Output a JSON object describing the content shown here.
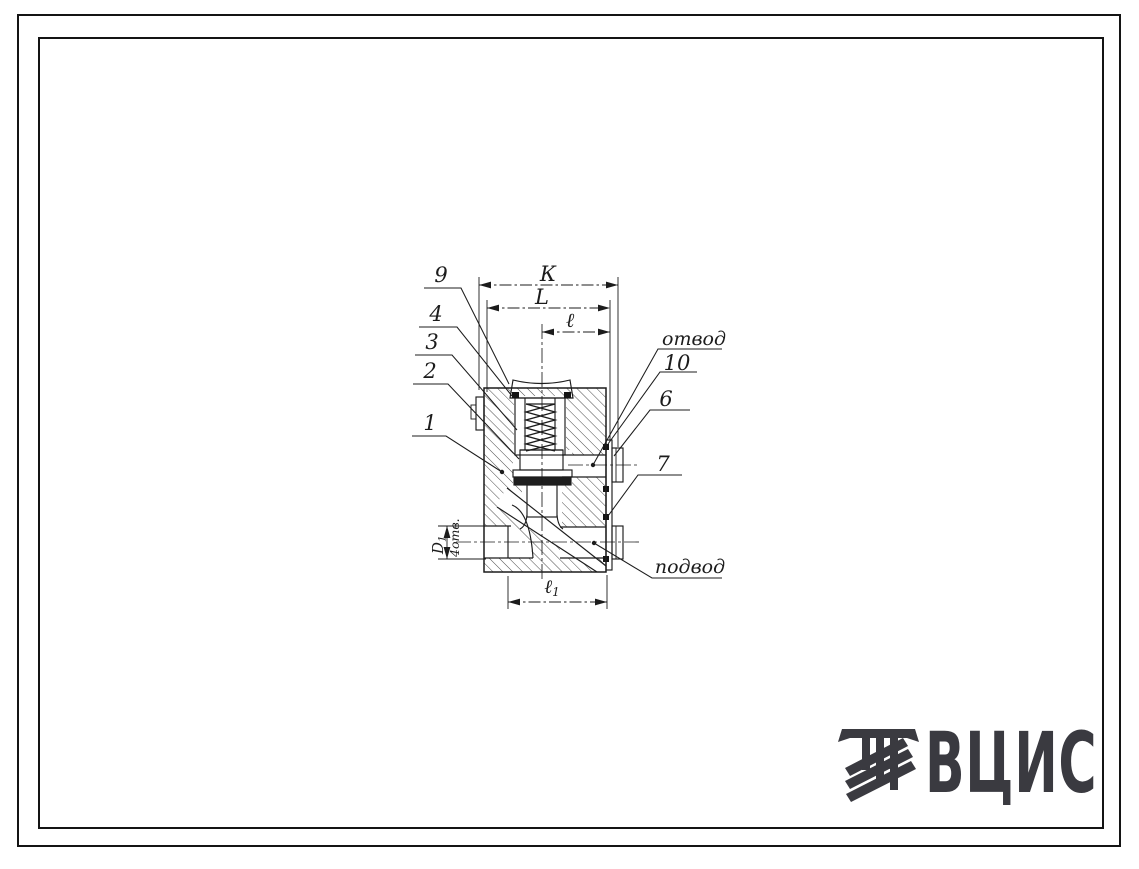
{
  "drawing": {
    "callouts": {
      "n9": "9",
      "n4": "4",
      "n3": "3",
      "n2": "2",
      "n1": "1",
      "n10": "10",
      "n6": "6",
      "n7": "7",
      "outlet_label": "отвод",
      "inlet_label": "подвод"
    },
    "dimensions": {
      "width_k": "К",
      "width_L": "L",
      "width_l": "ℓ",
      "l1_main": "ℓ",
      "l1_sub": "1",
      "d1_main": "D",
      "d1_sub": "1",
      "holes_note": "4отв."
    }
  },
  "logo": {
    "text": "ВЦИС"
  },
  "colors": {
    "ink": "#1c1c1c",
    "logo_color": "#3a3a40",
    "paper": "#ffffff"
  }
}
